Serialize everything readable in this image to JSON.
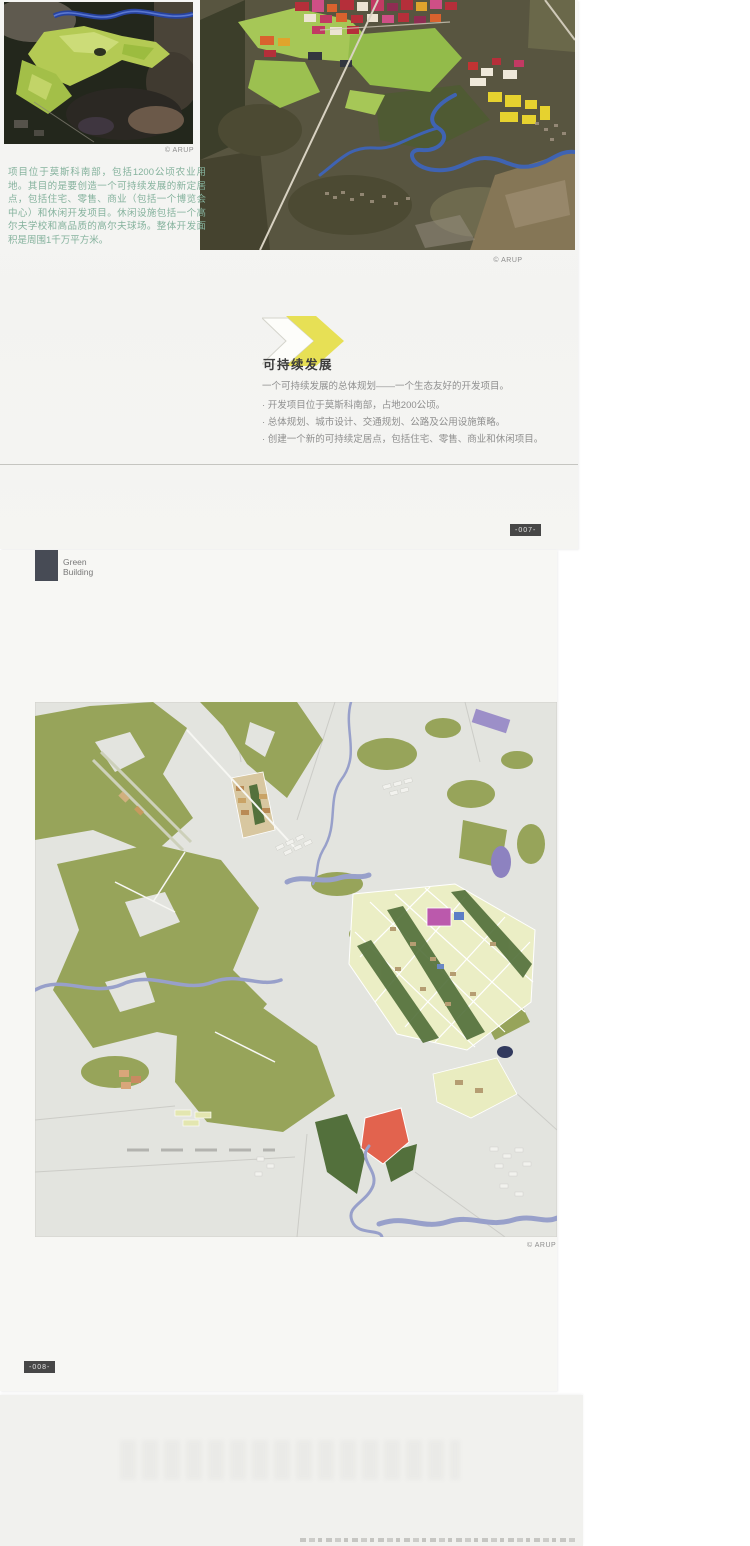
{
  "page007": {
    "photo_left_caption": "© ARUP",
    "photo_right_caption": "© ARUP",
    "intro_paragraph": "项目位于莫斯科南部，包括1200公顷农业用地。其目的是要创造一个可持续发展的新定居点，包括住宅、零售、商业（包括一个博览会中心）和休闲开发项目。休闲设施包括一个高尔夫学校和高品质的高尔夫球场。整体开发面积是周围1千万平方米。",
    "section": {
      "heading": "可持续发展",
      "intro": "一个可持续发展的总体规划——一个生态友好的开发项目。",
      "bullets": [
        "· 开发项目位于莫斯科南部，占地200公顷。",
        "· 总体规划、城市设计、交通规划、公路及公用设施策略。",
        "· 创建一个新的可持续定居点，包括住宅、零售、商业和休闲项目。"
      ]
    },
    "page_number": "-007-"
  },
  "page008": {
    "brand": {
      "line1": "Green",
      "line2": "Building"
    },
    "map_caption": "© ARUP",
    "page_number": "-008-"
  },
  "colors": {
    "accent_yellow": "#e7e055",
    "caption_green": "#85b29d",
    "badge_background": "#474747",
    "brand_square": "#474b55",
    "map_forest_olive": "#97a45a",
    "map_parcel_red": "#e2634e",
    "map_river_blue": "#98a0ca"
  }
}
